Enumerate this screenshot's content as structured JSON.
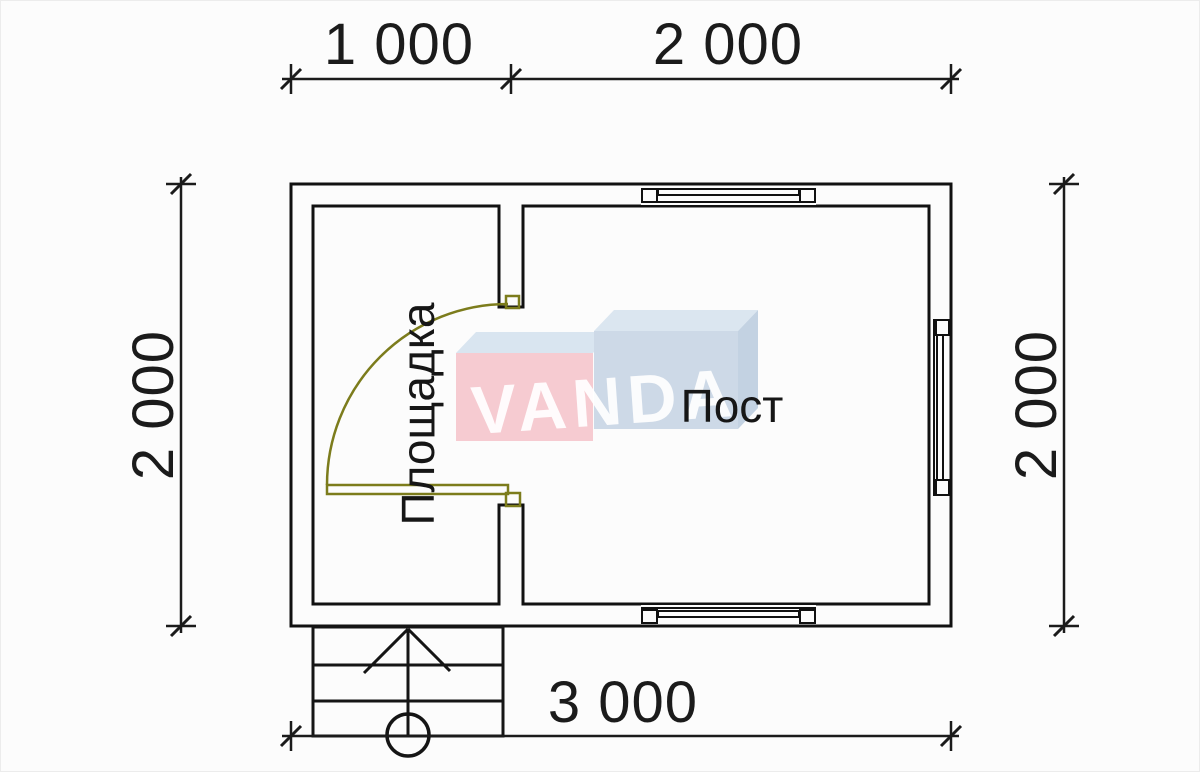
{
  "drawing": {
    "kind_label": "floor plan",
    "dimensions": {
      "top_segment_1": "1 000",
      "top_segment_2": "2 000",
      "left_height": "2 000",
      "right_height": "2 000",
      "bottom_width": "3 000"
    },
    "rooms": {
      "left_label": "Площадка",
      "right_label": "Пост"
    },
    "watermark": {
      "brand": "VANDA"
    },
    "colors": {
      "background": "#fcfcfc",
      "wall_fill": "#f8f6e8",
      "wall_hatch_line": "#8f9040",
      "wall_border": "#111111",
      "door_olive": "#7c7c1c",
      "dimension_line": "#1b1b1b",
      "watermark_pink_front": "#f6cbd1",
      "watermark_pink_top": "#d9e5f0",
      "watermark_blue_front": "#cdd9e7",
      "watermark_blue_top": "#dbe6f0",
      "watermark_blue_side": "#c3d2e2",
      "watermark_text": "#ffffff"
    }
  }
}
